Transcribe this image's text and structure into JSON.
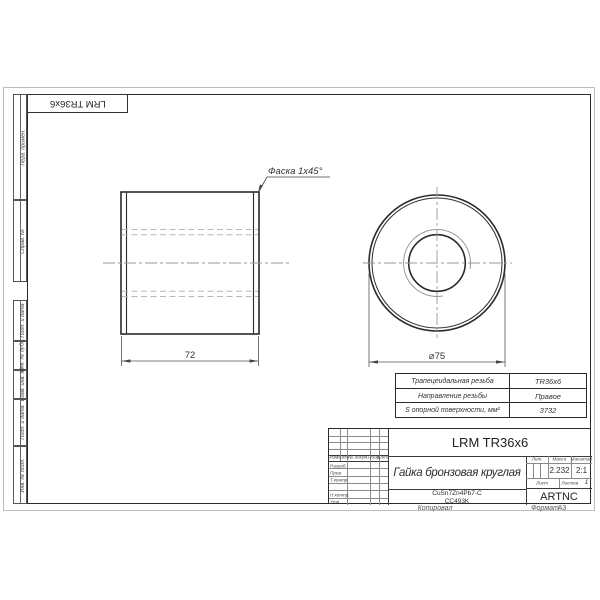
{
  "page": {
    "line_color": "#2a2a2a",
    "hidden_line_color": "#b8b8b8",
    "centerline_color": "#9a9a9a"
  },
  "stamp": {
    "designation": "LRM TR36x6"
  },
  "margin": {
    "boxes": [
      {
        "label": "Перв. примен."
      },
      {
        "label": "Справ. №"
      },
      {
        "label": "Подп. и дата"
      },
      {
        "label": "Инв. № дубл."
      },
      {
        "label": "Взам. инв. №"
      },
      {
        "label": "Подп. и дата"
      },
      {
        "label": "Инв. № подл."
      }
    ]
  },
  "views": {
    "chamfer_note": "Фаска 1x45°",
    "length_dim": "72",
    "diameter_dim": "⌀75"
  },
  "spec_table": {
    "rows": [
      {
        "label": "Трапецеидальная резьба",
        "value": "TR36x6"
      },
      {
        "label": "Направление резьбы",
        "value": "Правое"
      },
      {
        "label": "S опорной поверхности, мм²",
        "value": "3732"
      }
    ]
  },
  "title_block": {
    "designation": "LRM TR36x6",
    "part_name": "Гайка бронзовая круглая",
    "material_line1": "CuSn7Zn4Pb7-C",
    "material_line2": "CC493K",
    "company": "ARTNC",
    "lit_label": "Лит.",
    "mass_label": "Масса",
    "scale_label": "Масштаб",
    "mass_value": "2.232",
    "scale_value": "2:1",
    "sheet_label": "Лист",
    "sheets_label": "Листов",
    "sheets_value": "1",
    "header_cols": [
      "Изм.",
      "Лист",
      "№ докум.",
      "Подп.",
      "Дата"
    ],
    "sign_rows": [
      "Разраб.",
      "Пров.",
      "Т.контр.",
      "",
      "Н.контр.",
      "Утв."
    ]
  },
  "footer": {
    "copied_label": "Копировал",
    "format_label": "Формат",
    "format_value": "A3"
  }
}
